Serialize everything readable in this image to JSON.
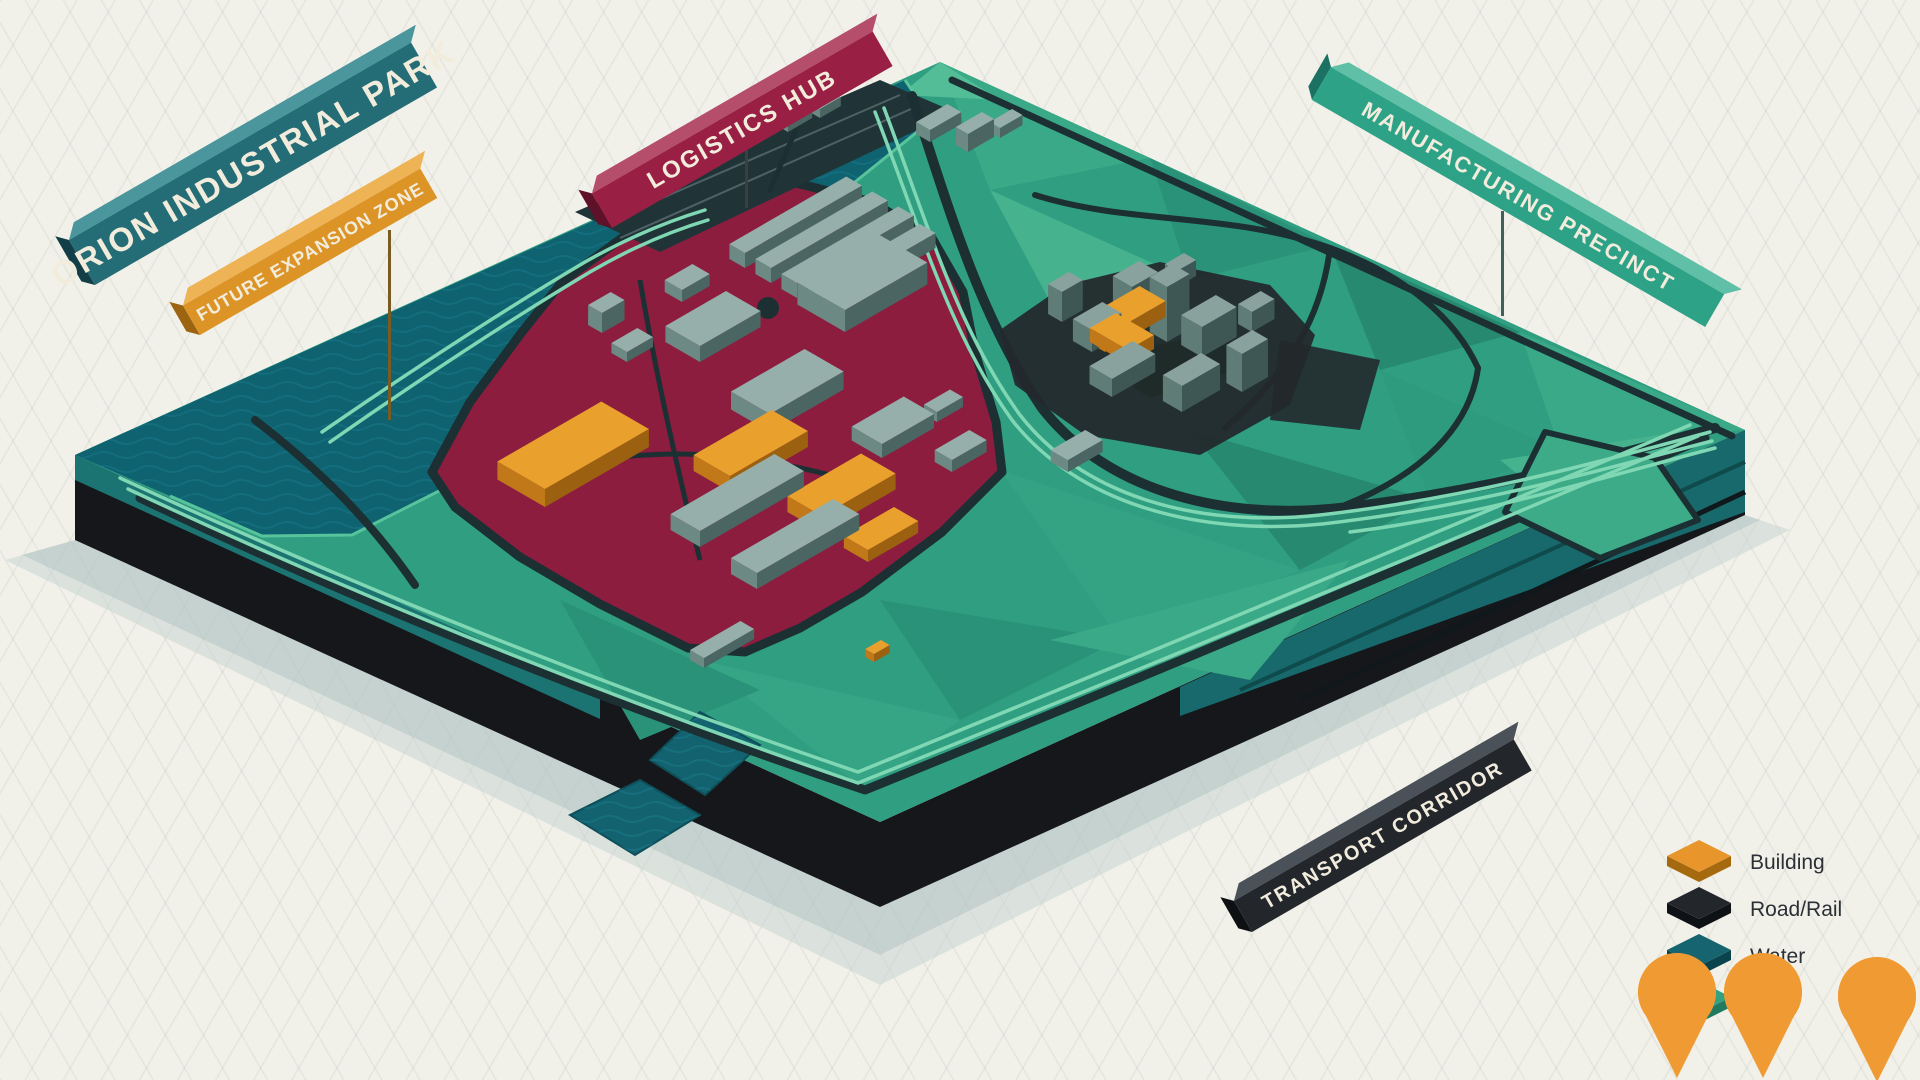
{
  "banners": {
    "title": {
      "label": "ORION INDUSTRIAL PARK",
      "color": "#256D76"
    },
    "future_expansion": {
      "label": "FUTURE EXPANSION ZONE",
      "color": "#DC9426"
    },
    "logistics_hub": {
      "label": "LOGISTICS HUB",
      "color": "#992044"
    },
    "manufacturing_precinct": {
      "label": "MANUFACTURING PRECINCT",
      "color": "#2EA287"
    },
    "transport_corridor": {
      "label": "TRANSPORT CORRIDOR",
      "color": "#23272C"
    }
  },
  "legend": {
    "items": [
      {
        "label": "Building",
        "color": "#E8952B"
      },
      {
        "label": "Road/Rail",
        "color": "#23272C"
      },
      {
        "label": "Water",
        "color": "#16646F"
      },
      {
        "label": "Land",
        "color": "#34A181"
      }
    ]
  },
  "markers": {
    "pin_color": "#F09A33",
    "count": 3
  },
  "map_colors": {
    "land": "#2F9E81",
    "water": "#0F6270",
    "industrial_district": "#8C1D3F",
    "road": "#1C2F33",
    "rail_light": "#7FD7B4",
    "building_gray": "#97AFAA",
    "building_orange": "#E9A02C",
    "block_side": "#15171B",
    "ground_shadow": "#B5C7C5",
    "background": "#F2F1E9"
  }
}
